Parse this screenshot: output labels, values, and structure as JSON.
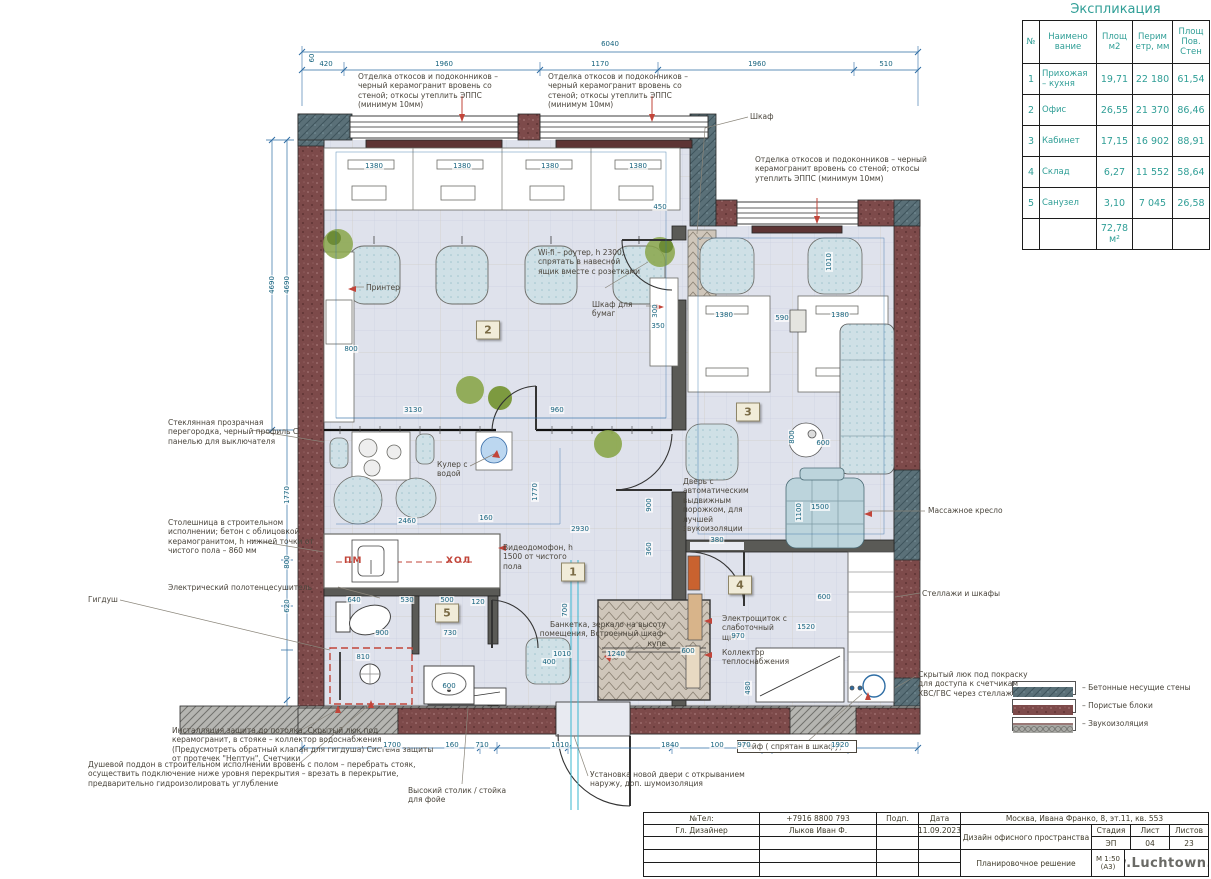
{
  "colors": {
    "wall_porous": "#7d4a4a",
    "wall_concrete": "#5a7078",
    "sound_insulation": "#a8a8a4",
    "floor": "#dfe2ec",
    "dimension_blue": "#2e6da4",
    "annotation_text": "#4a453c",
    "table_text": "#2f9e96",
    "red_marker": "#c2453a",
    "axis_cyan": "#3ab7cf"
  },
  "explication": {
    "title": "Экспликация",
    "headers": [
      "№",
      "Наимено вание",
      "Площ м2",
      "Перим етр, мм",
      "Площ Пов. Стен"
    ],
    "rows": [
      [
        "1",
        "Прихожая – кухня",
        "19,71",
        "22 180",
        "61,54"
      ],
      [
        "2",
        "Офис",
        "26,55",
        "21 370",
        "86,46"
      ],
      [
        "3",
        "Кабинет",
        "17,15",
        "16 902",
        "88,91"
      ],
      [
        "4",
        "Склад",
        "6,27",
        "11 552",
        "58,64"
      ],
      [
        "5",
        "Санузел",
        "3,10",
        "7 045",
        "26,58"
      ]
    ],
    "total": "72,78 м²"
  },
  "legend": {
    "items": [
      {
        "swatch": "concrete",
        "label": "– Бетонные несущие стены"
      },
      {
        "swatch": "porous",
        "label": "– Пористые блоки"
      },
      {
        "swatch": "sound",
        "label": "– Звукоизоляция"
      }
    ]
  },
  "room_labels": [
    {
      "n": "1",
      "x": 573,
      "y": 572
    },
    {
      "n": "2",
      "x": 488,
      "y": 330
    },
    {
      "n": "3",
      "x": 748,
      "y": 412
    },
    {
      "n": "4",
      "x": 740,
      "y": 585
    },
    {
      "n": "5",
      "x": 447,
      "y": 613
    }
  ],
  "annotations": [
    {
      "id": "finish-note-left",
      "text": "Отделка откосов и подоконников – черный керамогранит вровень со стеной; откосы утеплить ЭППС (минимум 10мм)",
      "x": 358,
      "y": 72,
      "w": 152
    },
    {
      "id": "finish-note-mid",
      "text": "Отделка откосов и подоконников – черный керамогранит вровень со стеной; откосы утеплить ЭППС (минимум 10мм)",
      "x": 548,
      "y": 72,
      "w": 152
    },
    {
      "id": "wardrobe-note",
      "text": "Шкаф",
      "x": 750,
      "y": 112,
      "w": 40
    },
    {
      "id": "finish-note-right",
      "text": "Отделка откосов и подоконников – черный керамогранит вровень со стеной; откосы утеплить ЭППС (минимум 10мм)",
      "x": 755,
      "y": 155,
      "w": 172
    },
    {
      "id": "wifi-note",
      "text": "Wi-fi – роутер, h 2300, спрятать в навесной ящик вместе с розетками",
      "x": 538,
      "y": 248,
      "w": 105
    },
    {
      "id": "printer-note",
      "text": "Принтер",
      "x": 366,
      "y": 283,
      "w": 45
    },
    {
      "id": "paper-cabinet-note",
      "text": "Шкаф для бумаг",
      "x": 592,
      "y": 300,
      "w": 55
    },
    {
      "id": "glass-partition-note",
      "text": "Стеклянная прозрачная перегородка, черный профиль С панелью для выключателя",
      "x": 168,
      "y": 418,
      "w": 150
    },
    {
      "id": "cooler-note",
      "text": "Кулер с водой",
      "x": 437,
      "y": 460,
      "w": 48
    },
    {
      "id": "countertop-note",
      "text": "Столешница в строительном исполнении; бетон с облицовкой керамогранитом, h нижней точки от чистого пола – 860 мм",
      "x": 168,
      "y": 518,
      "w": 165
    },
    {
      "id": "towel-rail-note",
      "text": "Электрический полотенцесушитель",
      "x": 168,
      "y": 583,
      "w": 175
    },
    {
      "id": "hygiene-shower-note",
      "text": "Гигдуш",
      "x": 88,
      "y": 595,
      "w": 60
    },
    {
      "id": "intercom-note",
      "text": "Видеодомофон, h 1500 от чистого пола",
      "x": 503,
      "y": 543,
      "w": 78
    },
    {
      "id": "auto-door-note",
      "text": "Дверь с автоматическим выдвижным порожком, для лучшей звукоизоляции",
      "x": 683,
      "y": 477,
      "w": 82
    },
    {
      "id": "bench-note",
      "text": "Банкетка, зеркало на высоту помещения, Встроенный шкаф-купе",
      "x": 536,
      "y": 620,
      "w": 130,
      "cls": "right"
    },
    {
      "id": "electro-panel-note",
      "text": "Электрощиток с слаботочный щит",
      "x": 722,
      "y": 614,
      "w": 68
    },
    {
      "id": "collector-note",
      "text": "Коллектор теплоснабжения",
      "x": 722,
      "y": 648,
      "w": 80
    },
    {
      "id": "massage-chair-note",
      "text": "Массажное кресло",
      "x": 928,
      "y": 506,
      "w": 95
    },
    {
      "id": "shelving-note",
      "text": "Стеллажи и шкафы",
      "x": 922,
      "y": 589,
      "w": 95
    },
    {
      "id": "hidden-hatch-note",
      "text": "Скрытый люк под покраску для доступа к счетчикам ХВС/ГВС через стеллаж",
      "x": 918,
      "y": 670,
      "w": 112
    },
    {
      "id": "installation-note",
      "text": "Инсталляция зашита до потолка, Скрытый люк под керамогранит, в стояке – коллектор водоснабжения (Предусмотреть обратный клапан для гигдуша) Система защиты от протечек \"Нептун\", Счетчики",
      "x": 172,
      "y": 726,
      "w": 265
    },
    {
      "id": "shower-tray-note",
      "text": "Душевой поддон в строительном исполнении вровень с полом – перебрать стояк, осуществить подключение ниже уровня перекрытия – врезать в перекрытие, предварительно гидроизолировать углубление",
      "x": 88,
      "y": 760,
      "w": 340
    },
    {
      "id": "high-table-note",
      "text": "Высокий столик / стойка для фойе",
      "x": 408,
      "y": 786,
      "w": 112
    },
    {
      "id": "new-door-note",
      "text": "Установка новой двери с открыванием наружу, доп. шумоизоляция",
      "x": 590,
      "y": 770,
      "w": 175
    },
    {
      "id": "safe-note",
      "text": "Сейф ( спрятан в шкафу)",
      "x": 737,
      "y": 740,
      "w": 110,
      "cls": "boxed"
    },
    {
      "id": "dishwasher-label",
      "text": "ПМ",
      "x": 344,
      "y": 556,
      "w": 30,
      "cls": "red"
    },
    {
      "id": "fridge-label",
      "text": "ХОЛ",
      "x": 446,
      "y": 556,
      "w": 40,
      "cls": "red"
    }
  ],
  "dimensions": [
    {
      "t": "6040",
      "x": 610,
      "y": 44
    },
    {
      "t": "60",
      "x": 312,
      "y": 58,
      "rot": true
    },
    {
      "t": "420",
      "x": 326,
      "y": 64
    },
    {
      "t": "1960",
      "x": 444,
      "y": 64
    },
    {
      "t": "1170",
      "x": 600,
      "y": 64
    },
    {
      "t": "1960",
      "x": 757,
      "y": 64
    },
    {
      "t": "510",
      "x": 886,
      "y": 64
    },
    {
      "t": "4690",
      "x": 272,
      "y": 285,
      "rot": true
    },
    {
      "t": "4690",
      "x": 287,
      "y": 285,
      "rot": true
    },
    {
      "t": "1770",
      "x": 287,
      "y": 495,
      "rot": true
    },
    {
      "t": "800",
      "x": 287,
      "y": 562,
      "rot": true
    },
    {
      "t": "620",
      "x": 287,
      "y": 606,
      "rot": true
    },
    {
      "t": "1380",
      "x": 374,
      "y": 166
    },
    {
      "t": "1380",
      "x": 462,
      "y": 166
    },
    {
      "t": "1380",
      "x": 550,
      "y": 166
    },
    {
      "t": "1380",
      "x": 638,
      "y": 166
    },
    {
      "t": "800",
      "x": 351,
      "y": 349
    },
    {
      "t": "3130",
      "x": 413,
      "y": 410
    },
    {
      "t": "960",
      "x": 557,
      "y": 410
    },
    {
      "t": "300",
      "x": 655,
      "y": 311,
      "rot": true
    },
    {
      "t": "350",
      "x": 658,
      "y": 326
    },
    {
      "t": "450",
      "x": 660,
      "y": 207
    },
    {
      "t": "1380",
      "x": 724,
      "y": 315
    },
    {
      "t": "590",
      "x": 782,
      "y": 318
    },
    {
      "t": "1380",
      "x": 840,
      "y": 315
    },
    {
      "t": "1010",
      "x": 829,
      "y": 262,
      "rot": true
    },
    {
      "t": "600",
      "x": 823,
      "y": 443
    },
    {
      "t": "800",
      "x": 792,
      "y": 437,
      "rot": true
    },
    {
      "t": "1500",
      "x": 820,
      "y": 507
    },
    {
      "t": "1100",
      "x": 799,
      "y": 512,
      "rot": true
    },
    {
      "t": "380",
      "x": 717,
      "y": 540
    },
    {
      "t": "2460",
      "x": 407,
      "y": 521
    },
    {
      "t": "160",
      "x": 486,
      "y": 518
    },
    {
      "t": "2930",
      "x": 580,
      "y": 529
    },
    {
      "t": "1770",
      "x": 535,
      "y": 492,
      "rot": true
    },
    {
      "t": "900",
      "x": 649,
      "y": 505,
      "rot": true
    },
    {
      "t": "360",
      "x": 649,
      "y": 549,
      "rot": true
    },
    {
      "t": "700",
      "x": 565,
      "y": 610,
      "rot": true
    },
    {
      "t": "1010",
      "x": 562,
      "y": 654
    },
    {
      "t": "1240",
      "x": 616,
      "y": 654
    },
    {
      "t": "600",
      "x": 688,
      "y": 651
    },
    {
      "t": "400",
      "x": 549,
      "y": 662
    },
    {
      "t": "640",
      "x": 354,
      "y": 600
    },
    {
      "t": "530",
      "x": 407,
      "y": 600
    },
    {
      "t": "500",
      "x": 447,
      "y": 600
    },
    {
      "t": "120",
      "x": 478,
      "y": 602
    },
    {
      "t": "900",
      "x": 382,
      "y": 633
    },
    {
      "t": "730",
      "x": 450,
      "y": 633
    },
    {
      "t": "810",
      "x": 363,
      "y": 657
    },
    {
      "t": "600",
      "x": 449,
      "y": 686
    },
    {
      "t": "1520",
      "x": 806,
      "y": 627
    },
    {
      "t": "970",
      "x": 738,
      "y": 636
    },
    {
      "t": "600",
      "x": 824,
      "y": 597
    },
    {
      "t": "480",
      "x": 748,
      "y": 688,
      "rot": true
    },
    {
      "t": "1700",
      "x": 392,
      "y": 745
    },
    {
      "t": "160",
      "x": 452,
      "y": 745
    },
    {
      "t": "710",
      "x": 482,
      "y": 745
    },
    {
      "t": "1010",
      "x": 560,
      "y": 745
    },
    {
      "t": "1840",
      "x": 670,
      "y": 745
    },
    {
      "t": "100",
      "x": 717,
      "y": 745
    },
    {
      "t": "970",
      "x": 744,
      "y": 745
    },
    {
      "t": "1920",
      "x": 840,
      "y": 745
    }
  ],
  "titleblock": {
    "phone_label": "№Тел:",
    "phone": "+7916 8800 793",
    "sign_label": "Подп.",
    "date_label": "Дата",
    "designer_label": "Гл. Дизайнер",
    "designer": "Лыков Иван Ф.",
    "date": "11.09.2023",
    "address": "Москва, Ивана Франко, 8, эт.11, кв. 553",
    "project": "Дизайн офисного пространства",
    "stage_label": "Стадия",
    "stage": "ЭП",
    "sheet_label": "Лист",
    "sheet": "04",
    "sheets_label": "Листов",
    "sheets": "23",
    "drawing": "Планировочное решение",
    "scale": "М 1:50 (А3)",
    "website": "www.Luchtown.com"
  }
}
